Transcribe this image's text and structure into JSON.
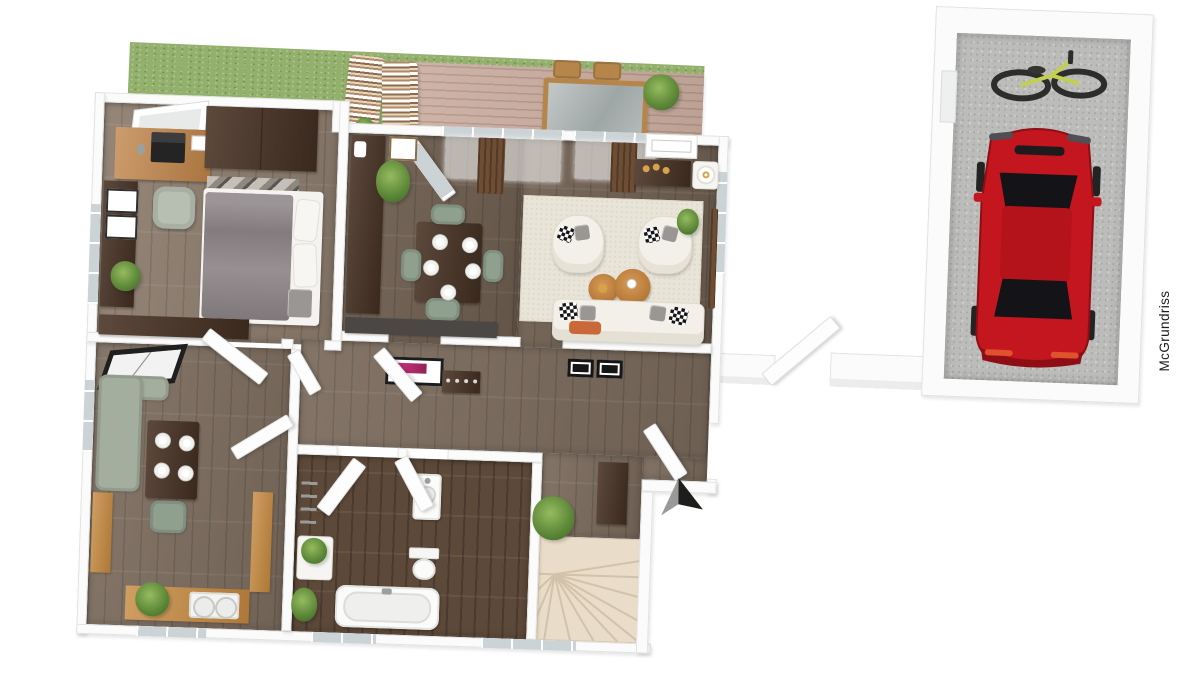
{
  "watermark": {
    "text": "McGrundriss"
  },
  "floor_plan": {
    "type": "3d-rendered-floor-plan",
    "compass": "north-arrow",
    "rooms": [
      "garden",
      "terrace",
      "bedroom",
      "dining-room",
      "living-room",
      "hallway",
      "kitchen",
      "bathroom",
      "staircase",
      "entrance",
      "garage"
    ],
    "furnishings": {
      "terrace": [
        "striped-lounger",
        "striped-lounger",
        "outdoor-table",
        "outdoor-chair",
        "outdoor-chair",
        "plant"
      ],
      "bedroom": [
        "desk",
        "laptop",
        "office-chair",
        "wardrobe",
        "double-bed",
        "bedside-rug",
        "dresser",
        "bench",
        "plant",
        "roof-window"
      ],
      "dining_room": [
        "sideboard",
        "wall-art",
        "plant",
        "dining-table",
        "chair",
        "chair",
        "chair",
        "chair",
        "lowboard"
      ],
      "living_room": [
        "area-rug",
        "armchair",
        "armchair",
        "coffee-table",
        "coffee-table",
        "sofa",
        "media-console",
        "mantel",
        "lamp",
        "plant",
        "curtains"
      ],
      "hallway": [
        "pink-wall-art",
        "coat-rack",
        "shoe-cabinet",
        "shoe-cabinet",
        "cabinet",
        "plant"
      ],
      "kitchen": [
        "corner-bench",
        "kitchen-table",
        "chair",
        "counter-with-double-sink",
        "counter",
        "plant",
        "roof-window"
      ],
      "bathroom": [
        "bathtub",
        "washbasin",
        "toilet",
        "towel-ladder",
        "storage-cube",
        "plant",
        "plant"
      ],
      "staircase": [
        "winder-stairs"
      ],
      "garage": [
        "red-car",
        "bicycle",
        "window"
      ]
    }
  },
  "colors": {
    "wall": "#fbfbfb",
    "wall-edge": "#e2e2e1",
    "wood-bedroom": "#8d7d6e",
    "wood-hall": "#7a6a5c",
    "wood-dining": "#6e5e50",
    "wood-kitchen": "#7d6d5f",
    "tile-bath": "#5d4939",
    "stairs": "#e9dcc8",
    "stairs-line": "#d2c2aa",
    "rug": "#e9e4d8",
    "grass": "#93b06c",
    "deck": "#c9ab9d",
    "furn-dark": "#4a3426",
    "desk-wood": "#c08448",
    "counter-wood": "#c5893f",
    "sage": "#a3ae9e",
    "sage-chair": "#8fa08f",
    "sofa": "#f2f0e9",
    "duvet": "#8e8689",
    "slab": "#4b4744",
    "car": "#c3161e",
    "car-shade": "#8f0e15",
    "bike": "#c3cf4e",
    "concrete": "#bcbcba",
    "glass": "#ccd3d6",
    "curtain": "#6d4e34",
    "arrow-dark": "#1d1d1b",
    "arrow-gray": "#99999a",
    "pink": "#d3307e",
    "orange": "#c9693a",
    "candle": "#d8a24a",
    "text": "#1c1c1c"
  }
}
